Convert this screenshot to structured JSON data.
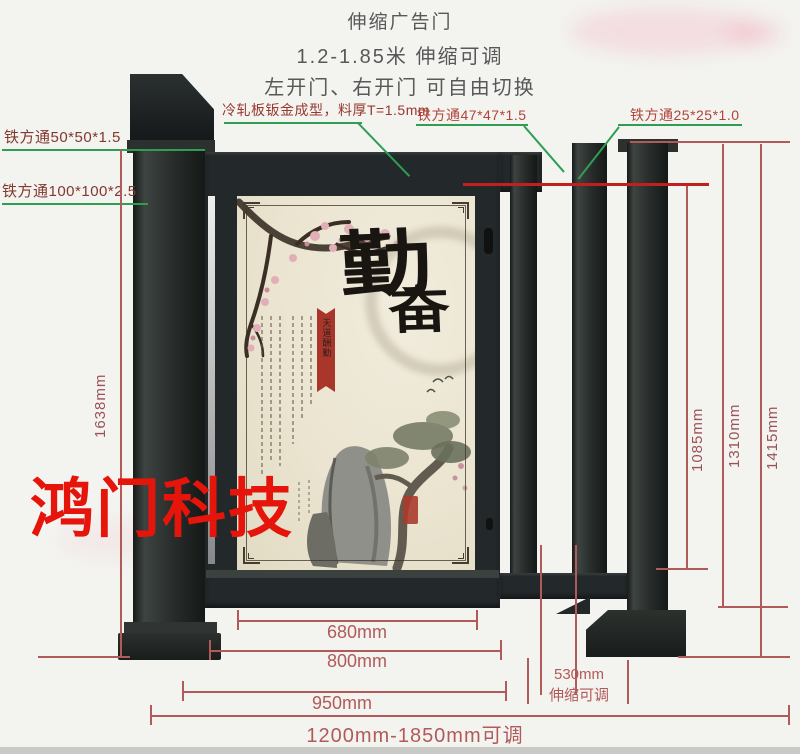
{
  "page": {
    "bg": "#f3f3f0",
    "bottom_strip": "#c9c9c6"
  },
  "header": {
    "line1": "伸缩广告门",
    "line2": "1.2-1.85米 伸缩可调",
    "line3": "左开门、右开门 可自由切换"
  },
  "callouts": {
    "square_tube_50": "铁方通50*50*1.5",
    "square_tube_100": "铁方通100*100*2.5",
    "cold_rolled_panel": "冷轧板钣金成型，料厚T=1.5mm",
    "square_tube_47": "铁方通47*47*1.5",
    "square_tube_25": "铁方通25*25*1.0"
  },
  "dimensions": {
    "pillar_height": "1638mm",
    "inner_height": "1085mm",
    "frame_height": "1310mm",
    "total_height": "1415mm",
    "poster_width": "680mm",
    "door_width": "800mm",
    "frame_width": "950mm",
    "extension_width": "530mm",
    "extension_note": "伸缩可调",
    "total_width": "1200mm-1850mm可调"
  },
  "poster": {
    "calligraphy_char_1": "勤",
    "calligraphy_char_2": "奋",
    "ribbon_text": "天道酬勤"
  },
  "watermark": "鸿门科技",
  "colors": {
    "dimension_red": "#b15a5a",
    "accent_red_line": "#c21f1f",
    "leader_green": "#2f9e53",
    "label_maroon": "#82392f",
    "label_red": "#b0443a",
    "watermark_red": "#e5150c",
    "gate_dark": "#23282a",
    "poster_paper": "#ece6d4",
    "ribbon_red": "#a8362b"
  }
}
